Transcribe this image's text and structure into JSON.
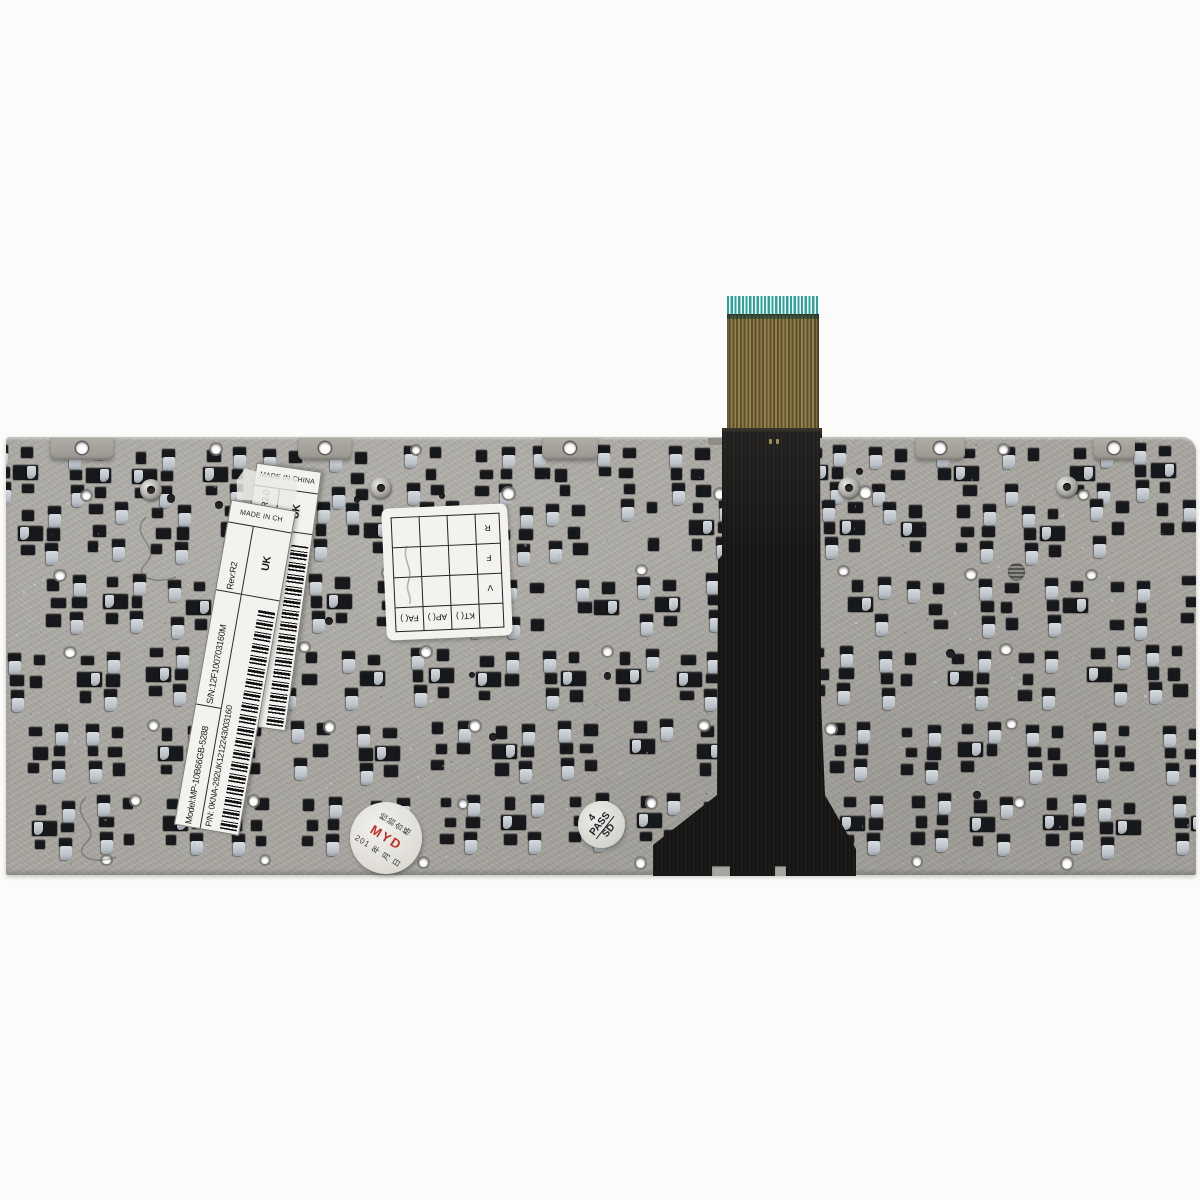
{
  "colors": {
    "plate": "#a9a6a0",
    "hole": "#17181b",
    "clip": "#c7ccd2",
    "ribbon_black": "#161514",
    "ffc_gold": "#93804a",
    "ffc_teal": "#2ba49d",
    "sticker_white": "#f4f2ee",
    "stamp_red": "#c22a22"
  },
  "labels": {
    "label_a": {
      "model": "Model:MP-10B66GB-5288",
      "serial": "S/N:12F100703160M",
      "revision": "Rev:R2.0",
      "pn_prefix": "P/N:",
      "pn": "04GOA292KUK01-212243003160",
      "country": "UK",
      "made_in": "MADE IN CHINA"
    },
    "label_b": {
      "model": "Model:MP-10B66GB-5288",
      "serial": "S/N:12F100703160M",
      "revision": "Rev:R2",
      "pn_prefix": "P/N:",
      "pn": "0KNA-292UK1212243003160",
      "country": "UK",
      "made_in": "MADE IN CH"
    }
  },
  "qc_grid": {
    "col_headers": [
      "KT(  )",
      "AP(  )",
      "FA(  )"
    ],
    "row_labels": [
      "V",
      "F",
      "R"
    ]
  },
  "stamps": {
    "myd": {
      "brand": "MYD",
      "inspection_text": "检验合格",
      "date_line": "201 年 月 日"
    },
    "pass": {
      "top": "4",
      "middle": "PASS",
      "bottom": "SD"
    }
  }
}
